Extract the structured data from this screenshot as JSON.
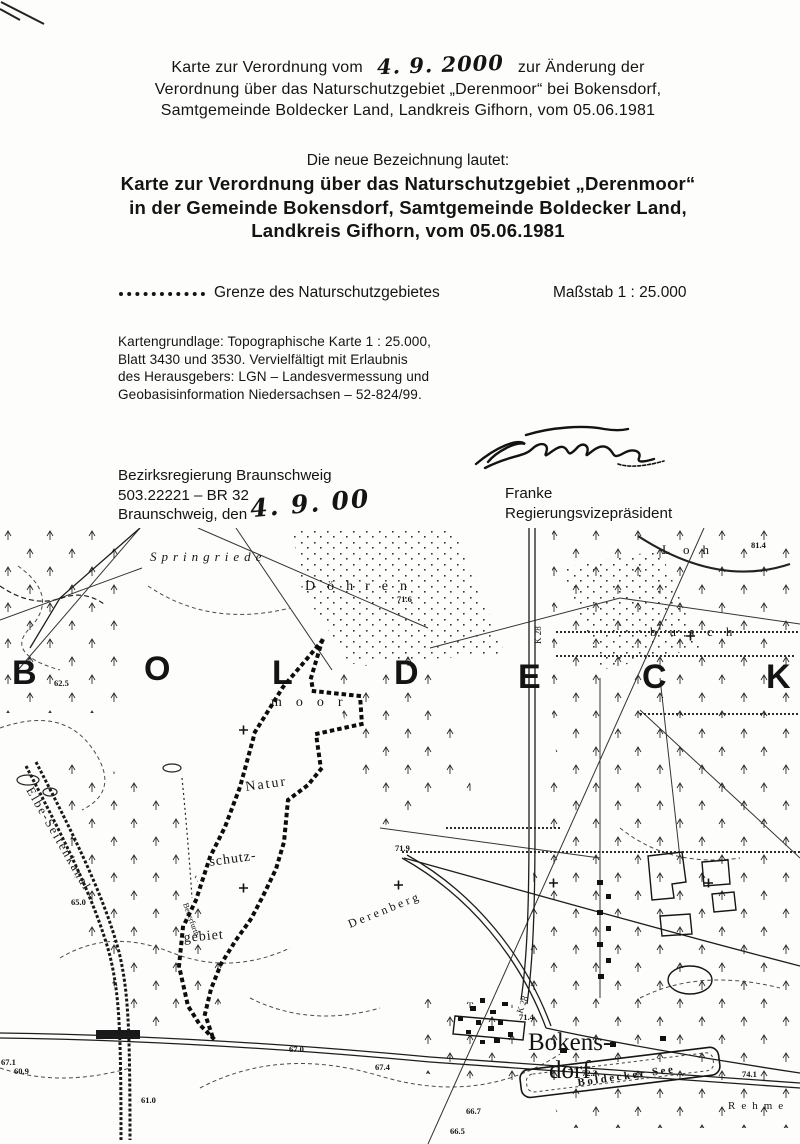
{
  "document": {
    "header_line1_pre": "Karte zur Verordnung vom",
    "header_date_handwritten": "4. 9. 2000",
    "header_line1_post": "zur Änderung der",
    "header_line2": "Verordnung über das Naturschutzgebiet „Derenmoor“ bei Bokensdorf,",
    "header_line3": "Samtgemeinde Boldecker Land, Landkreis Gifhorn, vom 05.06.1981",
    "subtitle_intro": "Die neue Bezeichnung lautet:",
    "title_line1": "Karte zur Verordnung über das Naturschutzgebiet „Derenmoor“",
    "title_line2": "in der Gemeinde Bokensdorf, Samtgemeinde Boldecker Land,",
    "title_line3": "Landkreis Gifhorn, vom 05.06.1981",
    "legend_label": "Grenze des Naturschutzgebietes",
    "scale_label": "Maßstab 1 : 25.000",
    "map_source": [
      "Kartengrundlage: Topographische Karte 1 : 25.000,",
      "Blatt 3430 und 3530. Vervielfältigt mit Erlaubnis",
      "des Herausgebers: LGN – Landesvermessung und",
      "Geobasisinformation Niedersachsen – 52-824/99."
    ],
    "authority_line1": "Bezirksregierung Braunschweig",
    "authority_line2": "503.22221 – BR 32",
    "authority_line3_pre": "Braunschweig, den",
    "authority_date_handwritten": "4. 9. 00",
    "signer_name": "Franke",
    "signer_title": "Regierungsvizepräsident"
  },
  "map": {
    "labels": [
      {
        "n": "region-letter",
        "text": "B",
        "x": 12,
        "y": 156,
        "s": 34,
        "w": "600",
        "f": "sans"
      },
      {
        "n": "region-letter",
        "text": "O",
        "x": 144,
        "y": 152,
        "s": 34,
        "w": "600",
        "f": "sans"
      },
      {
        "n": "region-letter",
        "text": "L",
        "x": 272,
        "y": 156,
        "s": 34,
        "w": "600",
        "f": "sans"
      },
      {
        "n": "region-letter",
        "text": "D",
        "x": 394,
        "y": 156,
        "s": 34,
        "w": "600",
        "f": "sans"
      },
      {
        "n": "region-letter",
        "text": "E",
        "x": 518,
        "y": 160,
        "s": 34,
        "w": "600",
        "f": "sans"
      },
      {
        "n": "region-letter",
        "text": "C",
        "x": 642,
        "y": 160,
        "s": 34,
        "w": "600",
        "f": "sans"
      },
      {
        "n": "region-letter",
        "text": "K",
        "x": 766,
        "y": 160,
        "s": 34,
        "w": "600",
        "f": "sans"
      },
      {
        "n": "place-label-springriede",
        "text": "Springriede",
        "x": 150,
        "y": 33,
        "s": 13,
        "i": 1,
        "ls": 5
      },
      {
        "n": "place-label-doehren",
        "text": "Döhren",
        "x": 305,
        "y": 62,
        "s": 14,
        "ls": 12
      },
      {
        "n": "place-label-loh",
        "text": "Loh",
        "x": 662,
        "y": 26,
        "s": 13,
        "ls": 13
      },
      {
        "n": "place-label-busch",
        "text": "busch",
        "x": 650,
        "y": 108,
        "s": 13,
        "ls": 13
      },
      {
        "n": "place-label-moor",
        "text": "moor",
        "x": 271,
        "y": 178,
        "s": 14,
        "ls": 14
      },
      {
        "n": "nsg-label-natur",
        "text": "Natur",
        "x": 246,
        "y": 263,
        "s": 14,
        "r": -8,
        "ls": 2
      },
      {
        "n": "nsg-label-schutz",
        "text": "schutz-",
        "x": 210,
        "y": 338,
        "s": 14,
        "r": -8,
        "ls": 1
      },
      {
        "n": "nsg-label-gebiet",
        "text": "gebiet",
        "x": 184,
        "y": 414,
        "s": 14,
        "r": -5,
        "ls": 1
      },
      {
        "n": "place-label-derenberg",
        "text": "Derenberg",
        "x": 350,
        "y": 400,
        "s": 12,
        "r": -22,
        "ls": 3
      },
      {
        "n": "place-label-bokensdorf-1",
        "text": "Bokens-",
        "x": 528,
        "y": 522,
        "s": 25
      },
      {
        "n": "place-label-bokensdorf-2",
        "text": "dorf",
        "x": 549,
        "y": 550,
        "s": 25
      },
      {
        "n": "lake-label-boldecker-see",
        "text": "Boldecker See",
        "x": 578,
        "y": 558,
        "s": 11,
        "w": "bold",
        "r": -8,
        "ls": 2.5
      },
      {
        "n": "place-label-rehme",
        "text": "Rehme",
        "x": 728,
        "y": 581,
        "s": 11,
        "ls": 6
      },
      {
        "n": "road-label-k28",
        "text": "K 28",
        "x": 541,
        "y": 116,
        "s": 9,
        "r": -90
      },
      {
        "n": "road-label-k28-south",
        "text": "K 28",
        "x": 522,
        "y": 486,
        "s": 9,
        "r": -70
      },
      {
        "n": "canal-label",
        "text": "Elbe-Seitenkanal",
        "x": 26,
        "y": 262,
        "s": 12.5,
        "r": 60,
        "ls": 2
      },
      {
        "n": "stream-label",
        "text": "Beuerfurth",
        "x": 183,
        "y": 376,
        "s": 8,
        "r": 70
      }
    ],
    "elevations": [
      {
        "v": "81.4",
        "x": 751,
        "y": 20
      },
      {
        "v": "71.6",
        "x": 397,
        "y": 74
      },
      {
        "v": "62.5",
        "x": 54,
        "y": 158
      },
      {
        "v": "65.0",
        "x": 71,
        "y": 377
      },
      {
        "v": "71.9",
        "x": 395,
        "y": 323
      },
      {
        "v": "71.4",
        "x": 519,
        "y": 492
      },
      {
        "v": "72.3",
        "x": 582,
        "y": 548
      },
      {
        "v": "66.7",
        "x": 466,
        "y": 586
      },
      {
        "v": "66.5",
        "x": 450,
        "y": 606
      },
      {
        "v": "60.9",
        "x": 14,
        "y": 546
      },
      {
        "v": "61.0",
        "x": 141,
        "y": 575
      },
      {
        "v": "67.0",
        "x": 289,
        "y": 524
      },
      {
        "v": "67.4",
        "x": 375,
        "y": 542
      },
      {
        "v": "67.1",
        "x": 1,
        "y": 537
      },
      {
        "v": "74.1",
        "x": 742,
        "y": 549
      }
    ]
  }
}
